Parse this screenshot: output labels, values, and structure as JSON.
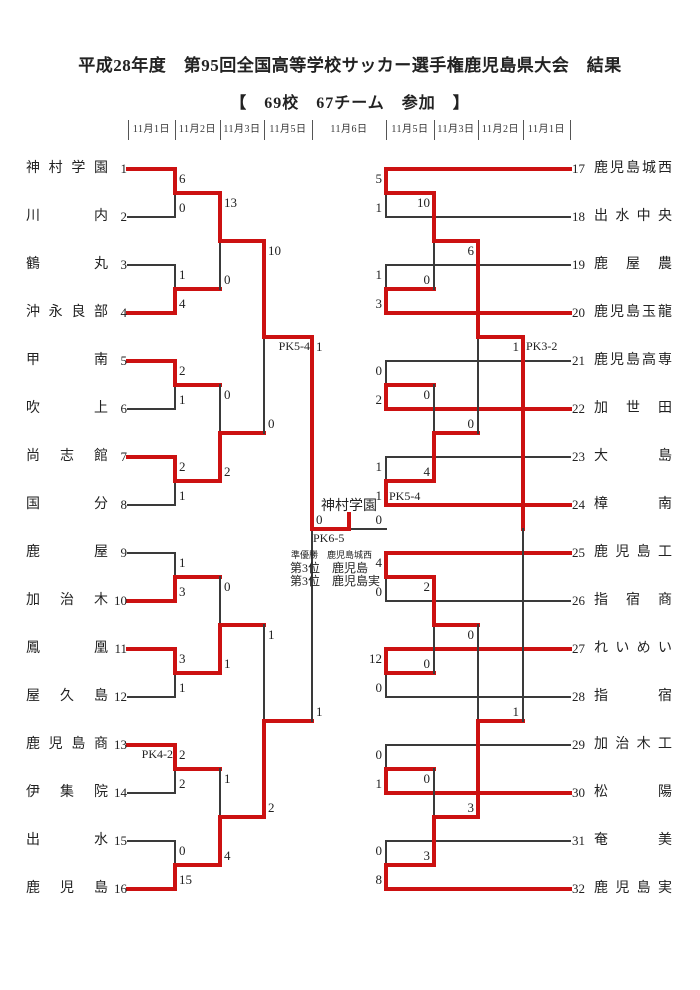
{
  "title": "平成28年度　第95回全国高等学校サッカー選手権鹿児島県大会　結果",
  "subtitle": "【　69校　67チーム　参加　】",
  "dates": [
    "11月1日",
    "11月2日",
    "11月3日",
    "11月5日",
    "11月6日",
    "11月5日",
    "11月3日",
    "11月2日",
    "11月1日"
  ],
  "colors": {
    "winner_line": "#cc1111",
    "line": "#3a3a3a",
    "text": "#222222"
  },
  "teams": {
    "left": [
      {
        "seed": "1",
        "name": "神村学園"
      },
      {
        "seed": "2",
        "name": "川内"
      },
      {
        "seed": "3",
        "name": "鶴丸"
      },
      {
        "seed": "4",
        "name": "沖永良部"
      },
      {
        "seed": "5",
        "name": "甲南"
      },
      {
        "seed": "6",
        "name": "吹上"
      },
      {
        "seed": "7",
        "name": "尚志館"
      },
      {
        "seed": "8",
        "name": "国分"
      },
      {
        "seed": "9",
        "name": "鹿屋"
      },
      {
        "seed": "10",
        "name": "加治木"
      },
      {
        "seed": "11",
        "name": "鳳凰"
      },
      {
        "seed": "12",
        "name": "屋久島"
      },
      {
        "seed": "13",
        "name": "鹿児島商"
      },
      {
        "seed": "14",
        "name": "伊集院"
      },
      {
        "seed": "15",
        "name": "出水"
      },
      {
        "seed": "16",
        "name": "鹿児島"
      }
    ],
    "right": [
      {
        "seed": "17",
        "name": "鹿児島城西"
      },
      {
        "seed": "18",
        "name": "出水中央"
      },
      {
        "seed": "19",
        "name": "鹿屋農"
      },
      {
        "seed": "20",
        "name": "鹿児島玉龍"
      },
      {
        "seed": "21",
        "name": "鹿児島高専"
      },
      {
        "seed": "22",
        "name": "加世田"
      },
      {
        "seed": "23",
        "name": "大島"
      },
      {
        "seed": "24",
        "name": "樟南"
      },
      {
        "seed": "25",
        "name": "鹿児島工"
      },
      {
        "seed": "26",
        "name": "指宿商"
      },
      {
        "seed": "27",
        "name": "れいめい"
      },
      {
        "seed": "28",
        "name": "指宿"
      },
      {
        "seed": "29",
        "name": "加治木工"
      },
      {
        "seed": "30",
        "name": "松陽"
      },
      {
        "seed": "31",
        "name": "奄美"
      },
      {
        "seed": "32",
        "name": "鹿児島実"
      }
    ]
  },
  "bracket": {
    "left": {
      "round1": [
        {
          "top_score": "6",
          "bottom_score": "0",
          "winner": "top"
        },
        {
          "top_score": "1",
          "bottom_score": "4",
          "winner": "bottom"
        },
        {
          "top_score": "2",
          "bottom_score": "1",
          "winner": "top"
        },
        {
          "top_score": "2",
          "bottom_score": "1",
          "winner": "top"
        },
        {
          "top_score": "1",
          "bottom_score": "3",
          "winner": "bottom"
        },
        {
          "top_score": "3",
          "bottom_score": "1",
          "winner": "top"
        },
        {
          "top_score": "2",
          "bottom_score": "2",
          "winner": "top",
          "note": "PK4-2"
        },
        {
          "top_score": "0",
          "bottom_score": "15",
          "winner": "bottom"
        }
      ],
      "round2": [
        {
          "top_score": "13",
          "bottom_score": "0",
          "winner": "top"
        },
        {
          "top_score": "0",
          "bottom_score": "2",
          "winner": "bottom"
        },
        {
          "top_score": "0",
          "bottom_score": "1",
          "winner": "bottom"
        },
        {
          "top_score": "1",
          "bottom_score": "4",
          "winner": "bottom"
        }
      ],
      "quarterfinals": [
        {
          "top_score": "10",
          "bottom_score": "0",
          "winner": "top"
        },
        {
          "top_score": "1",
          "bottom_score": "2",
          "winner": "bottom"
        }
      ],
      "semifinal": {
        "top_score": "1",
        "bottom_score": "1",
        "winner": "top",
        "note": "PK5-4"
      }
    },
    "right": {
      "round1": [
        {
          "top_score": "5",
          "bottom_score": "1",
          "winner": "top"
        },
        {
          "top_score": "1",
          "bottom_score": "3",
          "winner": "bottom"
        },
        {
          "top_score": "0",
          "bottom_score": "2",
          "winner": "bottom"
        },
        {
          "top_score": "1",
          "bottom_score": "1",
          "winner": "bottom",
          "note": "PK5-4"
        },
        {
          "top_score": "4",
          "bottom_score": "0",
          "winner": "top"
        },
        {
          "top_score": "12",
          "bottom_score": "0",
          "winner": "top"
        },
        {
          "top_score": "0",
          "bottom_score": "1",
          "winner": "bottom"
        },
        {
          "top_score": "0",
          "bottom_score": "8",
          "winner": "bottom"
        }
      ],
      "round2": [
        {
          "top_score": "10",
          "bottom_score": "0",
          "winner": "top"
        },
        {
          "top_score": "0",
          "bottom_score": "4",
          "winner": "bottom"
        },
        {
          "top_score": "2",
          "bottom_score": "0",
          "winner": "top"
        },
        {
          "top_score": "0",
          "bottom_score": "3",
          "winner": "bottom"
        }
      ],
      "quarterfinals": [
        {
          "top_score": "6",
          "bottom_score": "0",
          "winner": "top"
        },
        {
          "top_score": "0",
          "bottom_score": "3",
          "winner": "bottom"
        }
      ],
      "semifinal": {
        "top_score": "1",
        "bottom_score": "1",
        "winner": "top",
        "note": "PK3-2"
      }
    },
    "final": {
      "left_score": "0",
      "right_score": "0",
      "winner": "left",
      "note": "PK6-5",
      "champion": "神村学園"
    }
  },
  "results": {
    "runner_up": "準優勝　鹿児島城西",
    "third_place": [
      "第3位　鹿児島",
      "第3位　鹿児島実"
    ]
  }
}
